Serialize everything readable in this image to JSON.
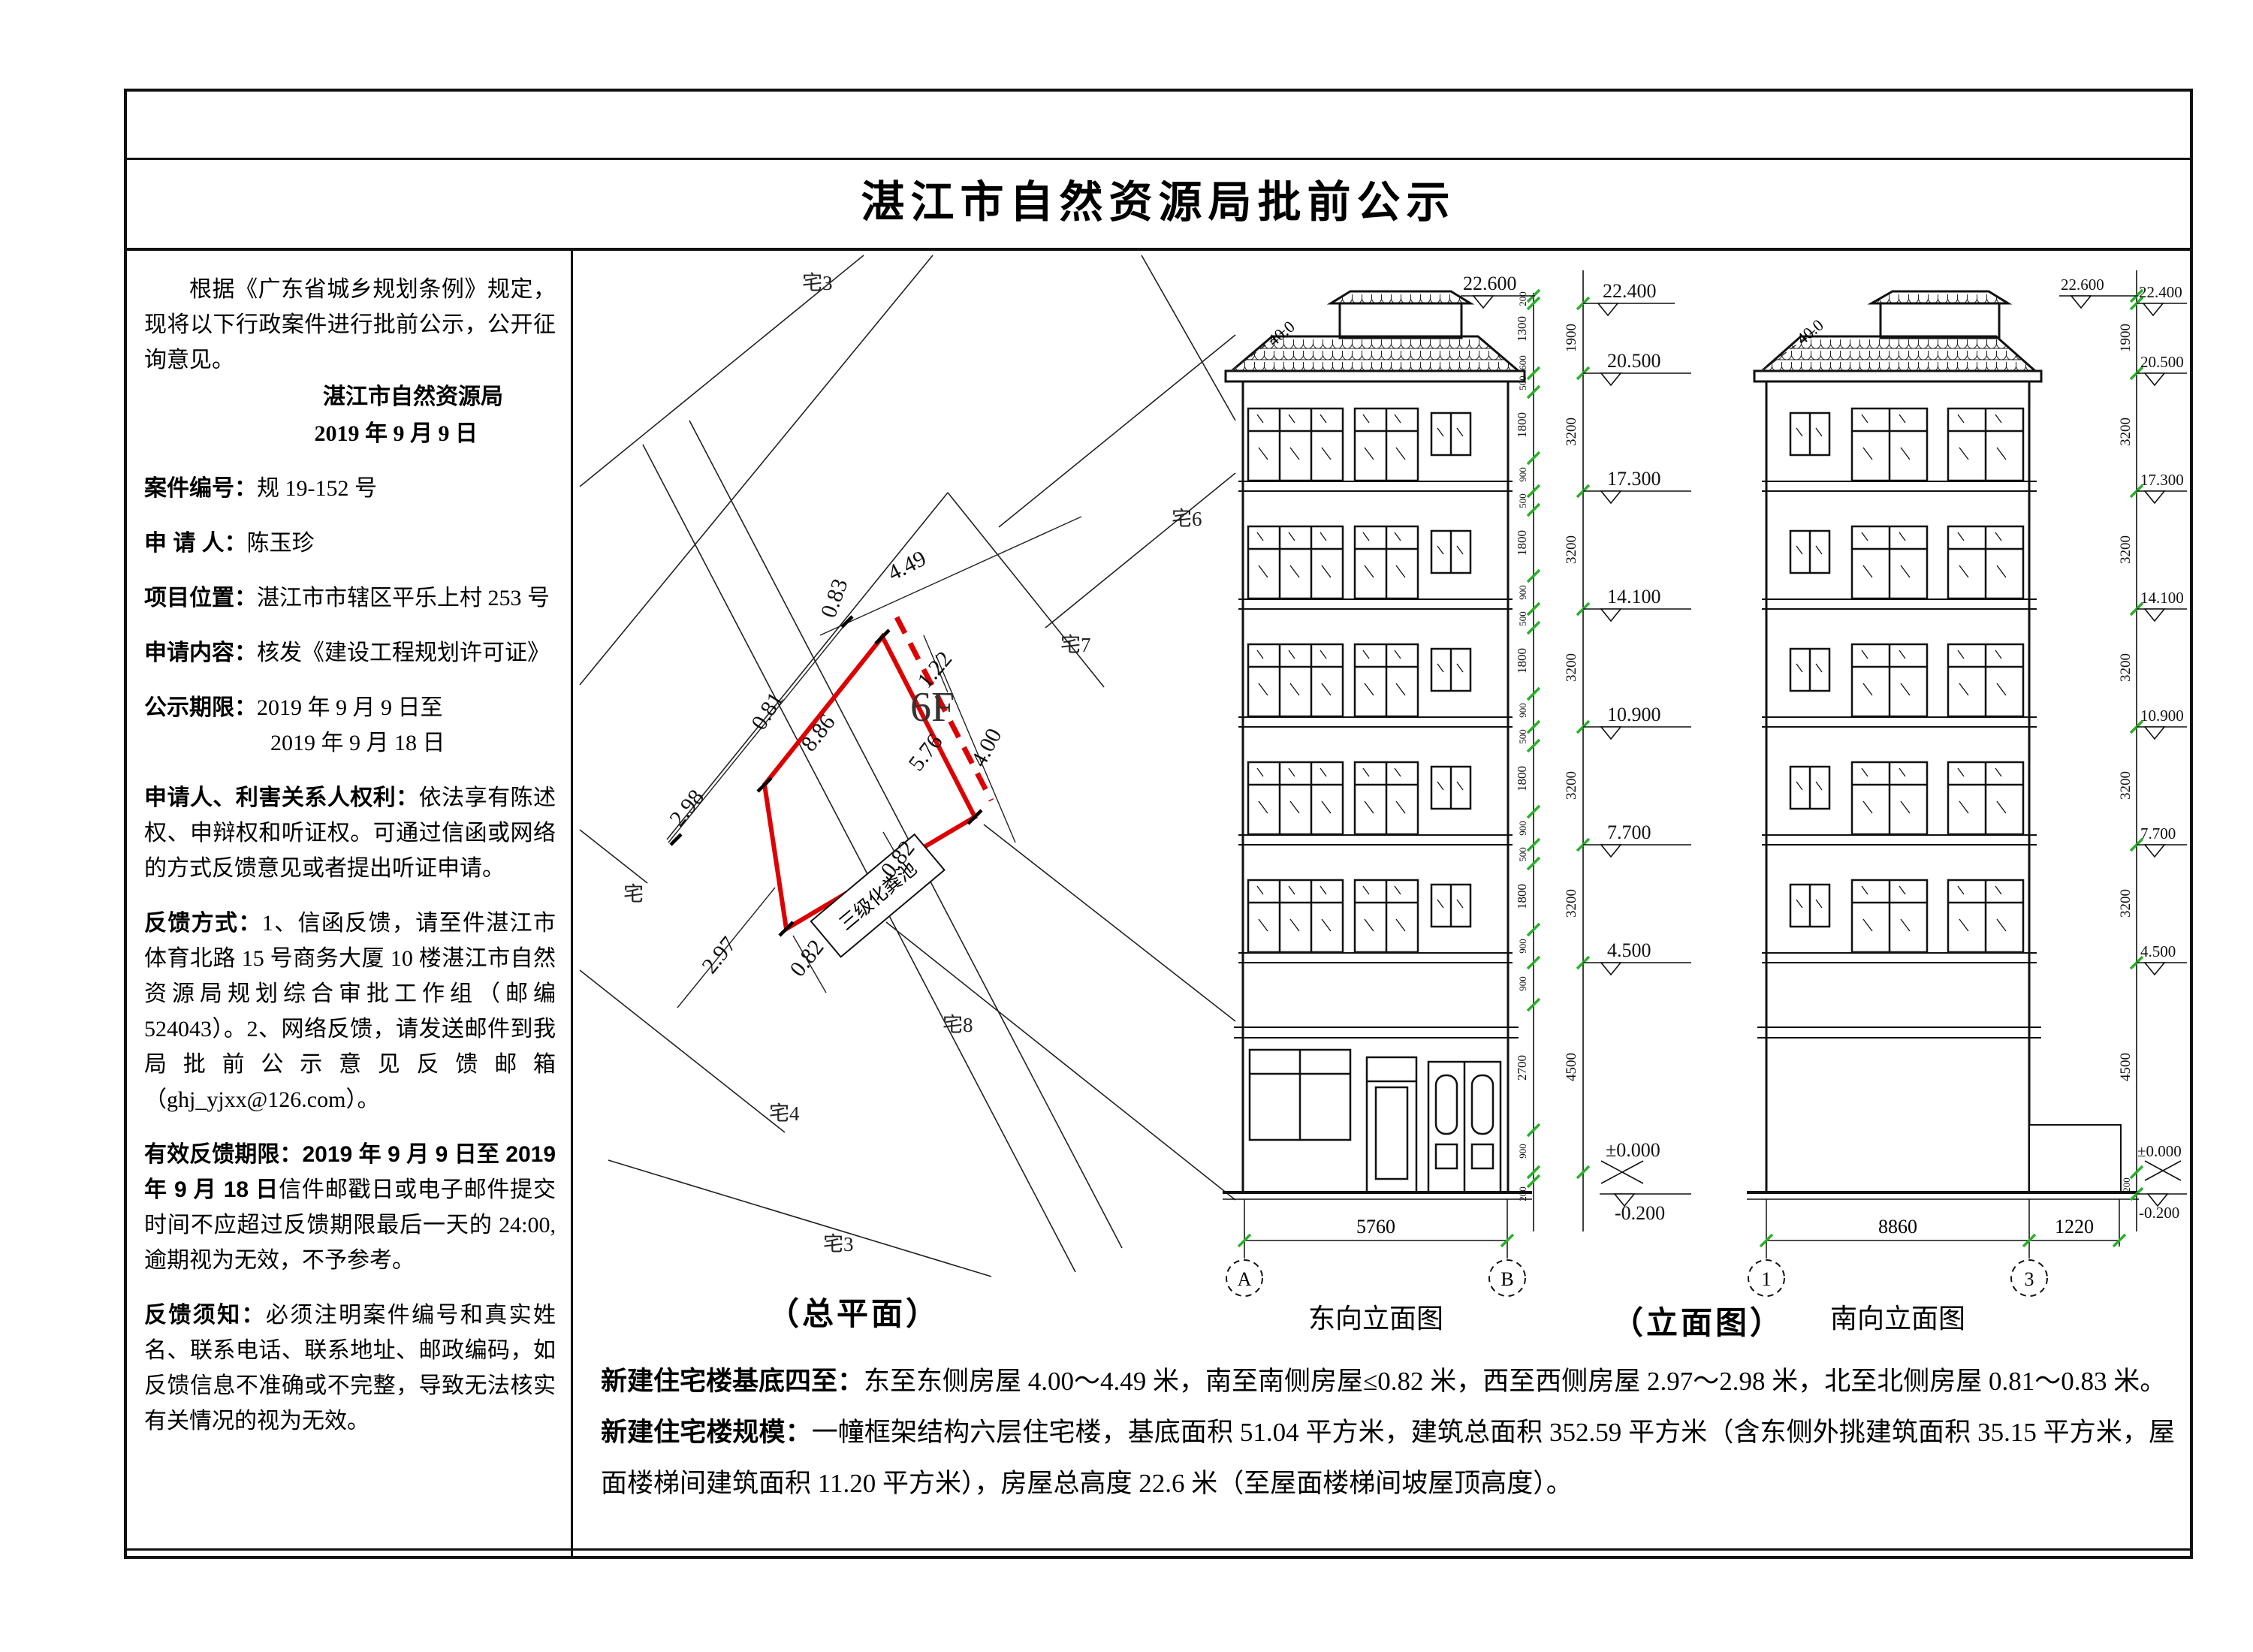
{
  "title": "湛江市自然资源局批前公示",
  "sidebar": {
    "intro": "根据《广东省城乡规划条例》规定，现将以下行政案件进行批前公示，公开征询意见。",
    "issuer": "湛江市自然资源局",
    "issue_date": "2019 年 9 月 9 日",
    "fields": {
      "case_label": "案件编号：",
      "case_no": "规 19-152 号",
      "applicant_label": "申 请 人：",
      "applicant": "陈玉珍",
      "location_label": "项目位置：",
      "location": "湛江市市辖区平乐上村 253 号",
      "content_label": "申请内容：",
      "content": "核发《建设工程规划许可证》",
      "period_label": "公示期限：",
      "period1": "2019 年 9 月 9 日至",
      "period2": "2019 年 9 月 18 日"
    },
    "rights_label": "申请人、利害关系人权利：",
    "rights_text": "依法享有陈述权、申辩权和听证权。可通过信函或网络的方式反馈意见或者提出听证申请。",
    "feedback_label": "反馈方式：",
    "feedback_text": "1、信函反馈，请至件湛江市体育北路 15 号商务大厦 10 楼湛江市自然资源局规划综合审批工作组（邮编 524043）。2、网络反馈，请发送邮件到我局批前公示意见反馈邮箱（ghj_yjxx@126.com）。",
    "deadline_label": "有效反馈期限：",
    "deadline_bold": "2019 年 9 月 9 日至 2019 年 9 月 18 日",
    "deadline_text": "信件邮戳日或电子邮件提交时间不应超过反馈期限最后一天的 24:00,逾期视为无效，不予参考。",
    "notice_label": "反馈须知：",
    "notice_text": "必须注明案件编号和真实姓名、联系电话、联系地址、邮政编码，如反馈信息不准确或不完整，导致无法核实有关情况的视为无效。"
  },
  "site_plan": {
    "caption": "（总平面）",
    "building_floors": "6F",
    "septic_label": "三级化粪池",
    "dims": {
      "d083": "0.83",
      "d449": "4.49",
      "d122": "1.22",
      "d576": "5.76",
      "d400": "4.00",
      "d886": "8.86",
      "d081": "0.81",
      "d298": "2.98",
      "d297": "2.97",
      "d082a": "0.82",
      "d082b": "0.82"
    },
    "parcels": {
      "p3t": "宅3",
      "p6": "宅6",
      "p7": "宅7",
      "p8": "宅8",
      "p4": "宅4",
      "p3b": "宅3",
      "pl": "宅"
    },
    "accent_red": "#dd0000"
  },
  "elevations": {
    "caption": "（立面图）",
    "east": {
      "name": "东向立面图",
      "gridA": "A",
      "gridB": "B",
      "width_dim": "5760"
    },
    "south": {
      "name": "南向立面图",
      "grid1": "1",
      "grid3": "3",
      "width_dim": "8860",
      "width_dim2": "1220"
    },
    "slope": "40.0",
    "levels": {
      "l226": "22.600",
      "l224": "22.400",
      "l205": "20.500",
      "l173": "17.300",
      "l141": "14.100",
      "l109": "10.900",
      "l77": "7.700",
      "l45": "4.500",
      "zero": "±0.000",
      "minus": "-0.200"
    },
    "vdims": {
      "v200": "200",
      "v1300": "1300",
      "v600": "600",
      "v500": "500",
      "v900": "900",
      "v1800": "1800",
      "v1900": "1900",
      "v2700": "2700",
      "v3200": "3200",
      "v4500": "4500"
    },
    "tick_green": "#2ab02a"
  },
  "notes": {
    "p1_label": "新建住宅楼基底四至：",
    "p1_text": "东至东侧房屋 4.00～4.49 米，南至南侧房屋≤0.82 米，西至西侧房屋 2.97～2.98 米，北至北侧房屋 0.81～0.83 米。",
    "p2_label": "新建住宅楼规模：",
    "p2_text": "一幢框架结构六层住宅楼，基底面积 51.04 平方米，建筑总面积 352.59 平方米（含东侧外挑建筑面积 35.15 平方米，屋面楼梯间建筑面积 11.20 平方米），房屋总高度 22.6 米（至屋面楼梯间坡屋顶高度）。"
  }
}
